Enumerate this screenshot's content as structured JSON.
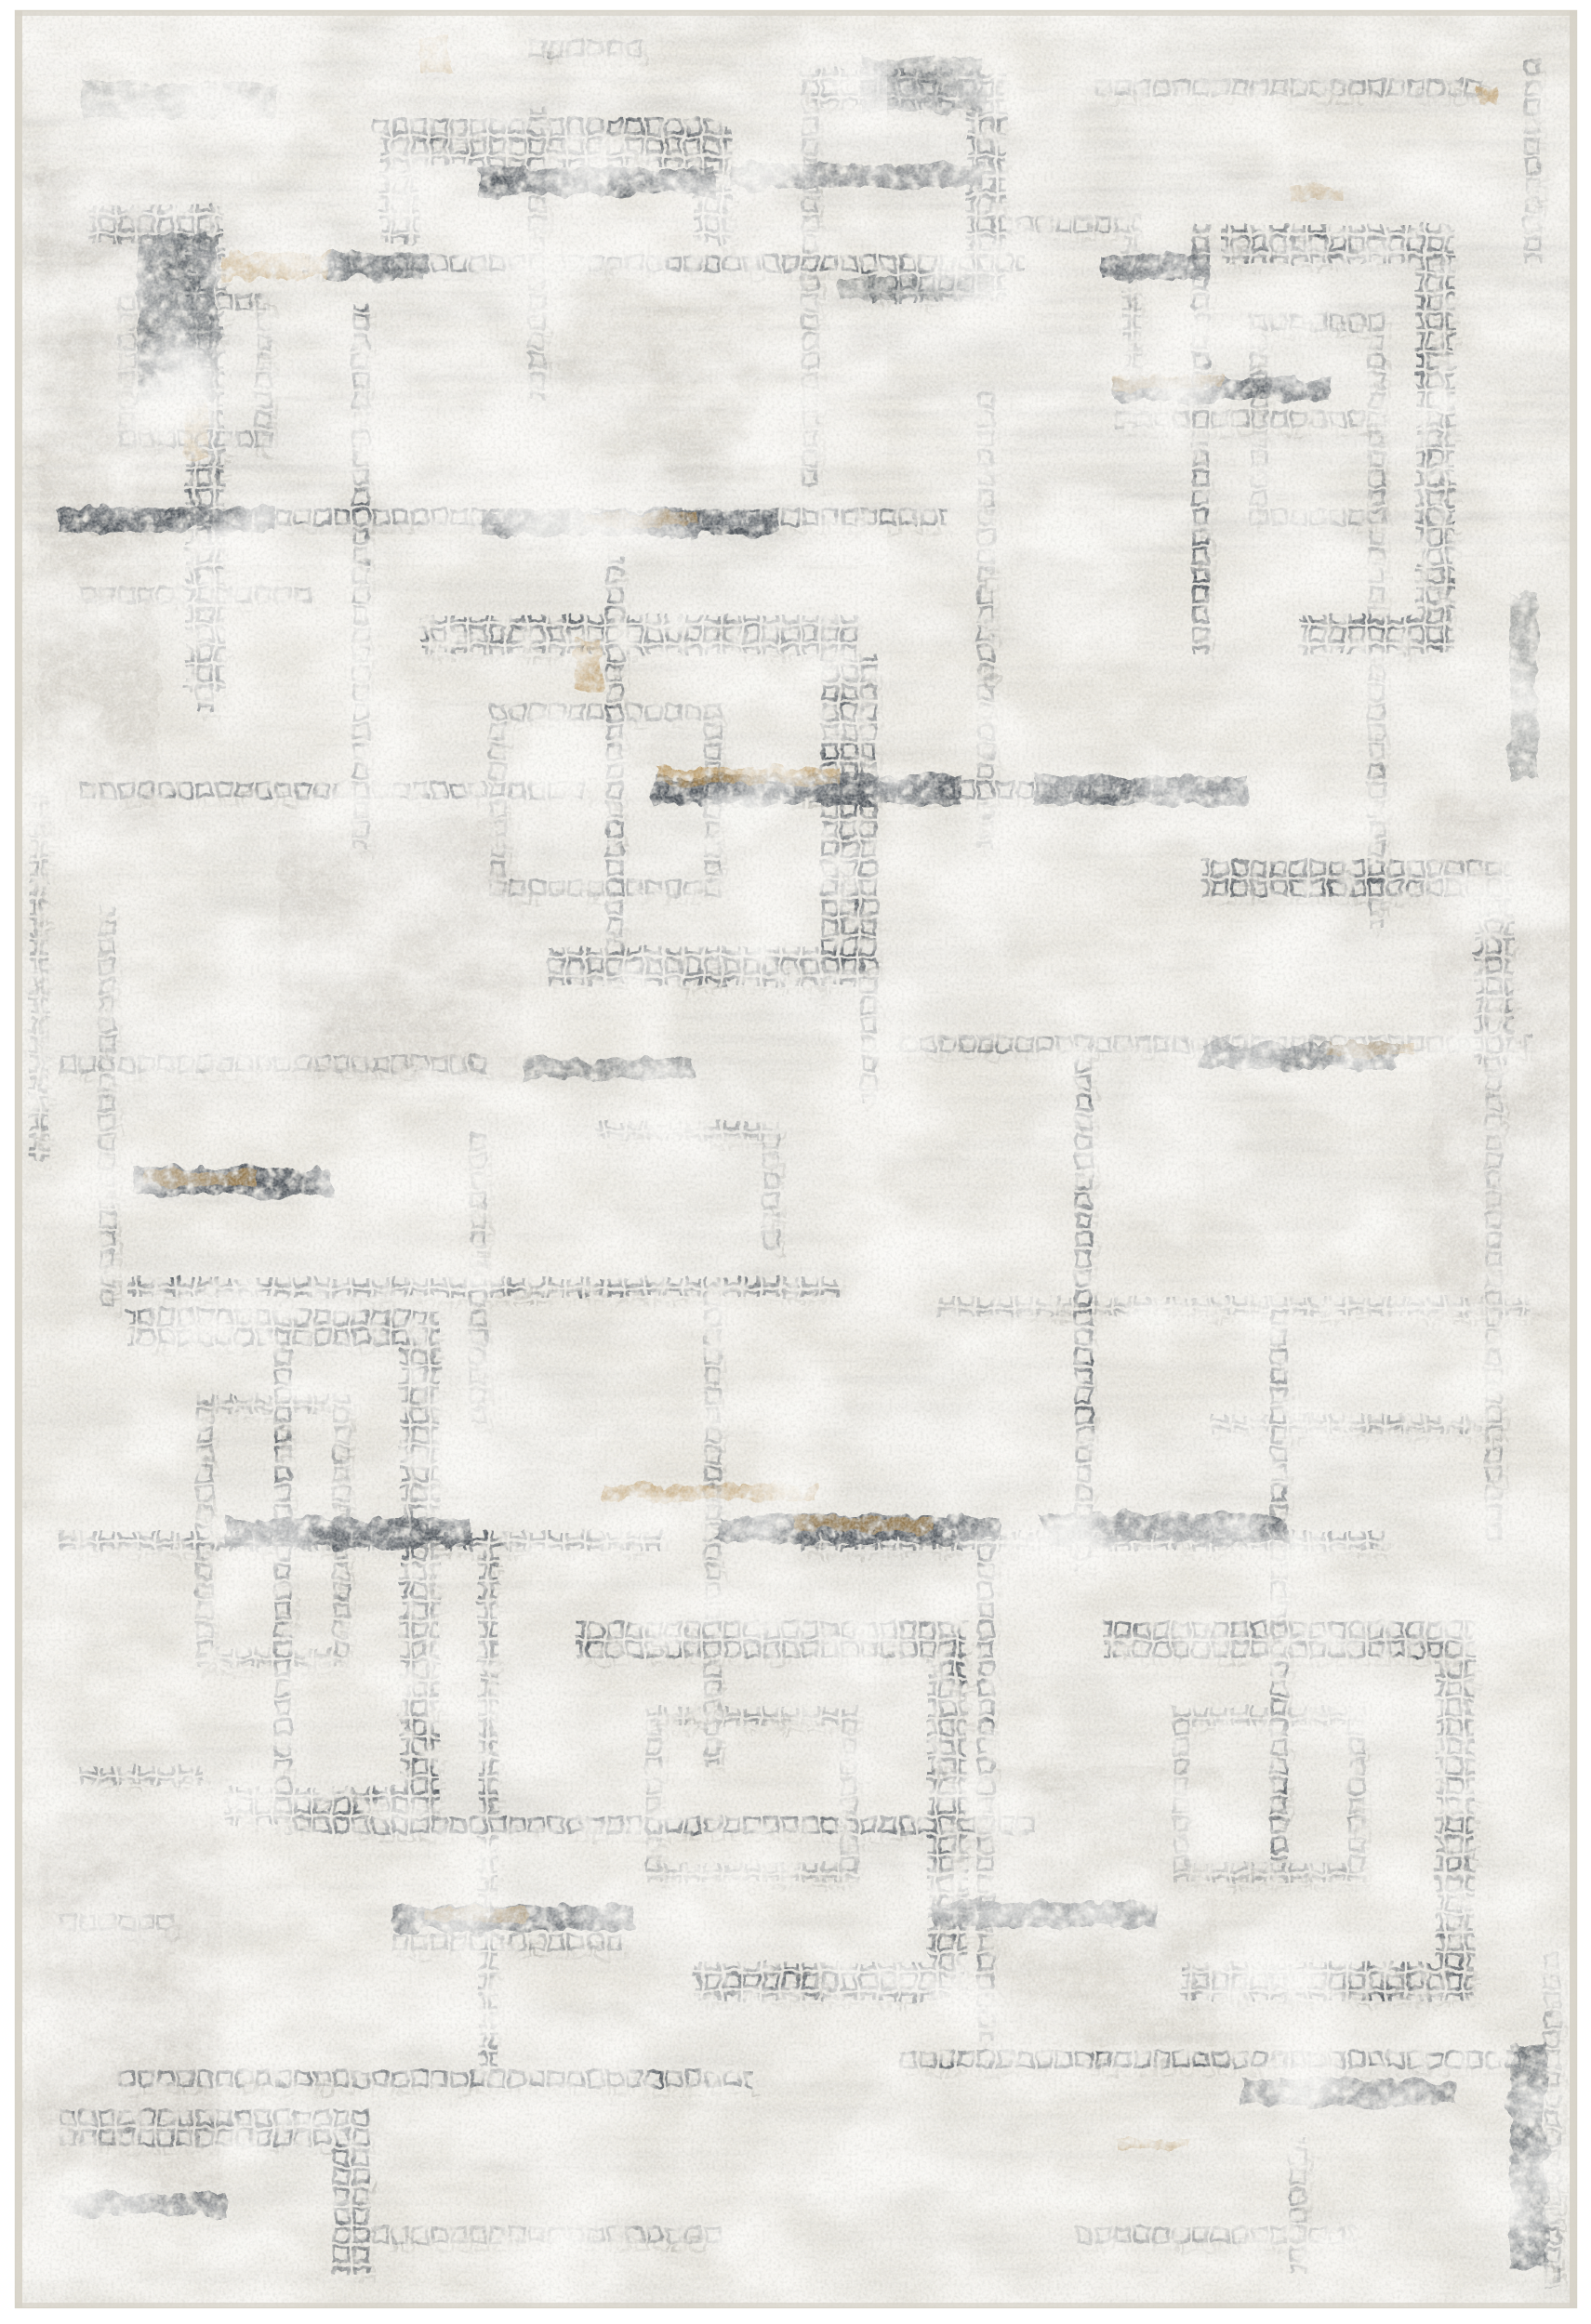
{
  "description": "Product photo of a distressed modern area rug: an eroded interlocking geometric fretwork of small charcoal squares over an ivory and pale gray textured pile, with scattered tan-gold accents and heavy white wear patches.",
  "colors": {
    "photo-bg": "#ffffff",
    "rug-base": "#e8e5dd",
    "rug-light": "#f4f2ec",
    "mottle": "#cdc9bf",
    "shade": "#c2beb5",
    "ink": "#4b5158",
    "ink-strong": "#3e444b",
    "ghost": "#aeaca4",
    "gold": "#b0884a",
    "edge": "#d6d2c7",
    "streak": "#a09e98",
    "grain-dark": "#74736f",
    "grain-light": "#fbfaf7",
    "wear": "#f3f1ea"
  }
}
